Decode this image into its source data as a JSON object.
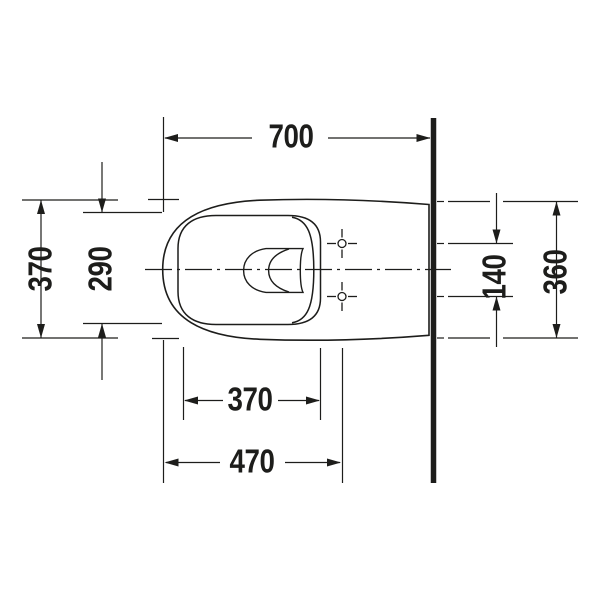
{
  "drawing": {
    "type": "technical-plan-view",
    "subject": "wall-hung-toilet-top-view",
    "colors": {
      "line": "#1d1d1b",
      "wall": "#1d1d1b",
      "background": "#ffffff"
    },
    "dimensions": {
      "overall_depth": "700",
      "overall_width_front": "370",
      "inner_bowl_width": "290",
      "mounting_hole_spacing": "140",
      "width_at_wall": "360",
      "inner_bowl_depth": "370",
      "front_to_mounting_holes": "470"
    }
  }
}
